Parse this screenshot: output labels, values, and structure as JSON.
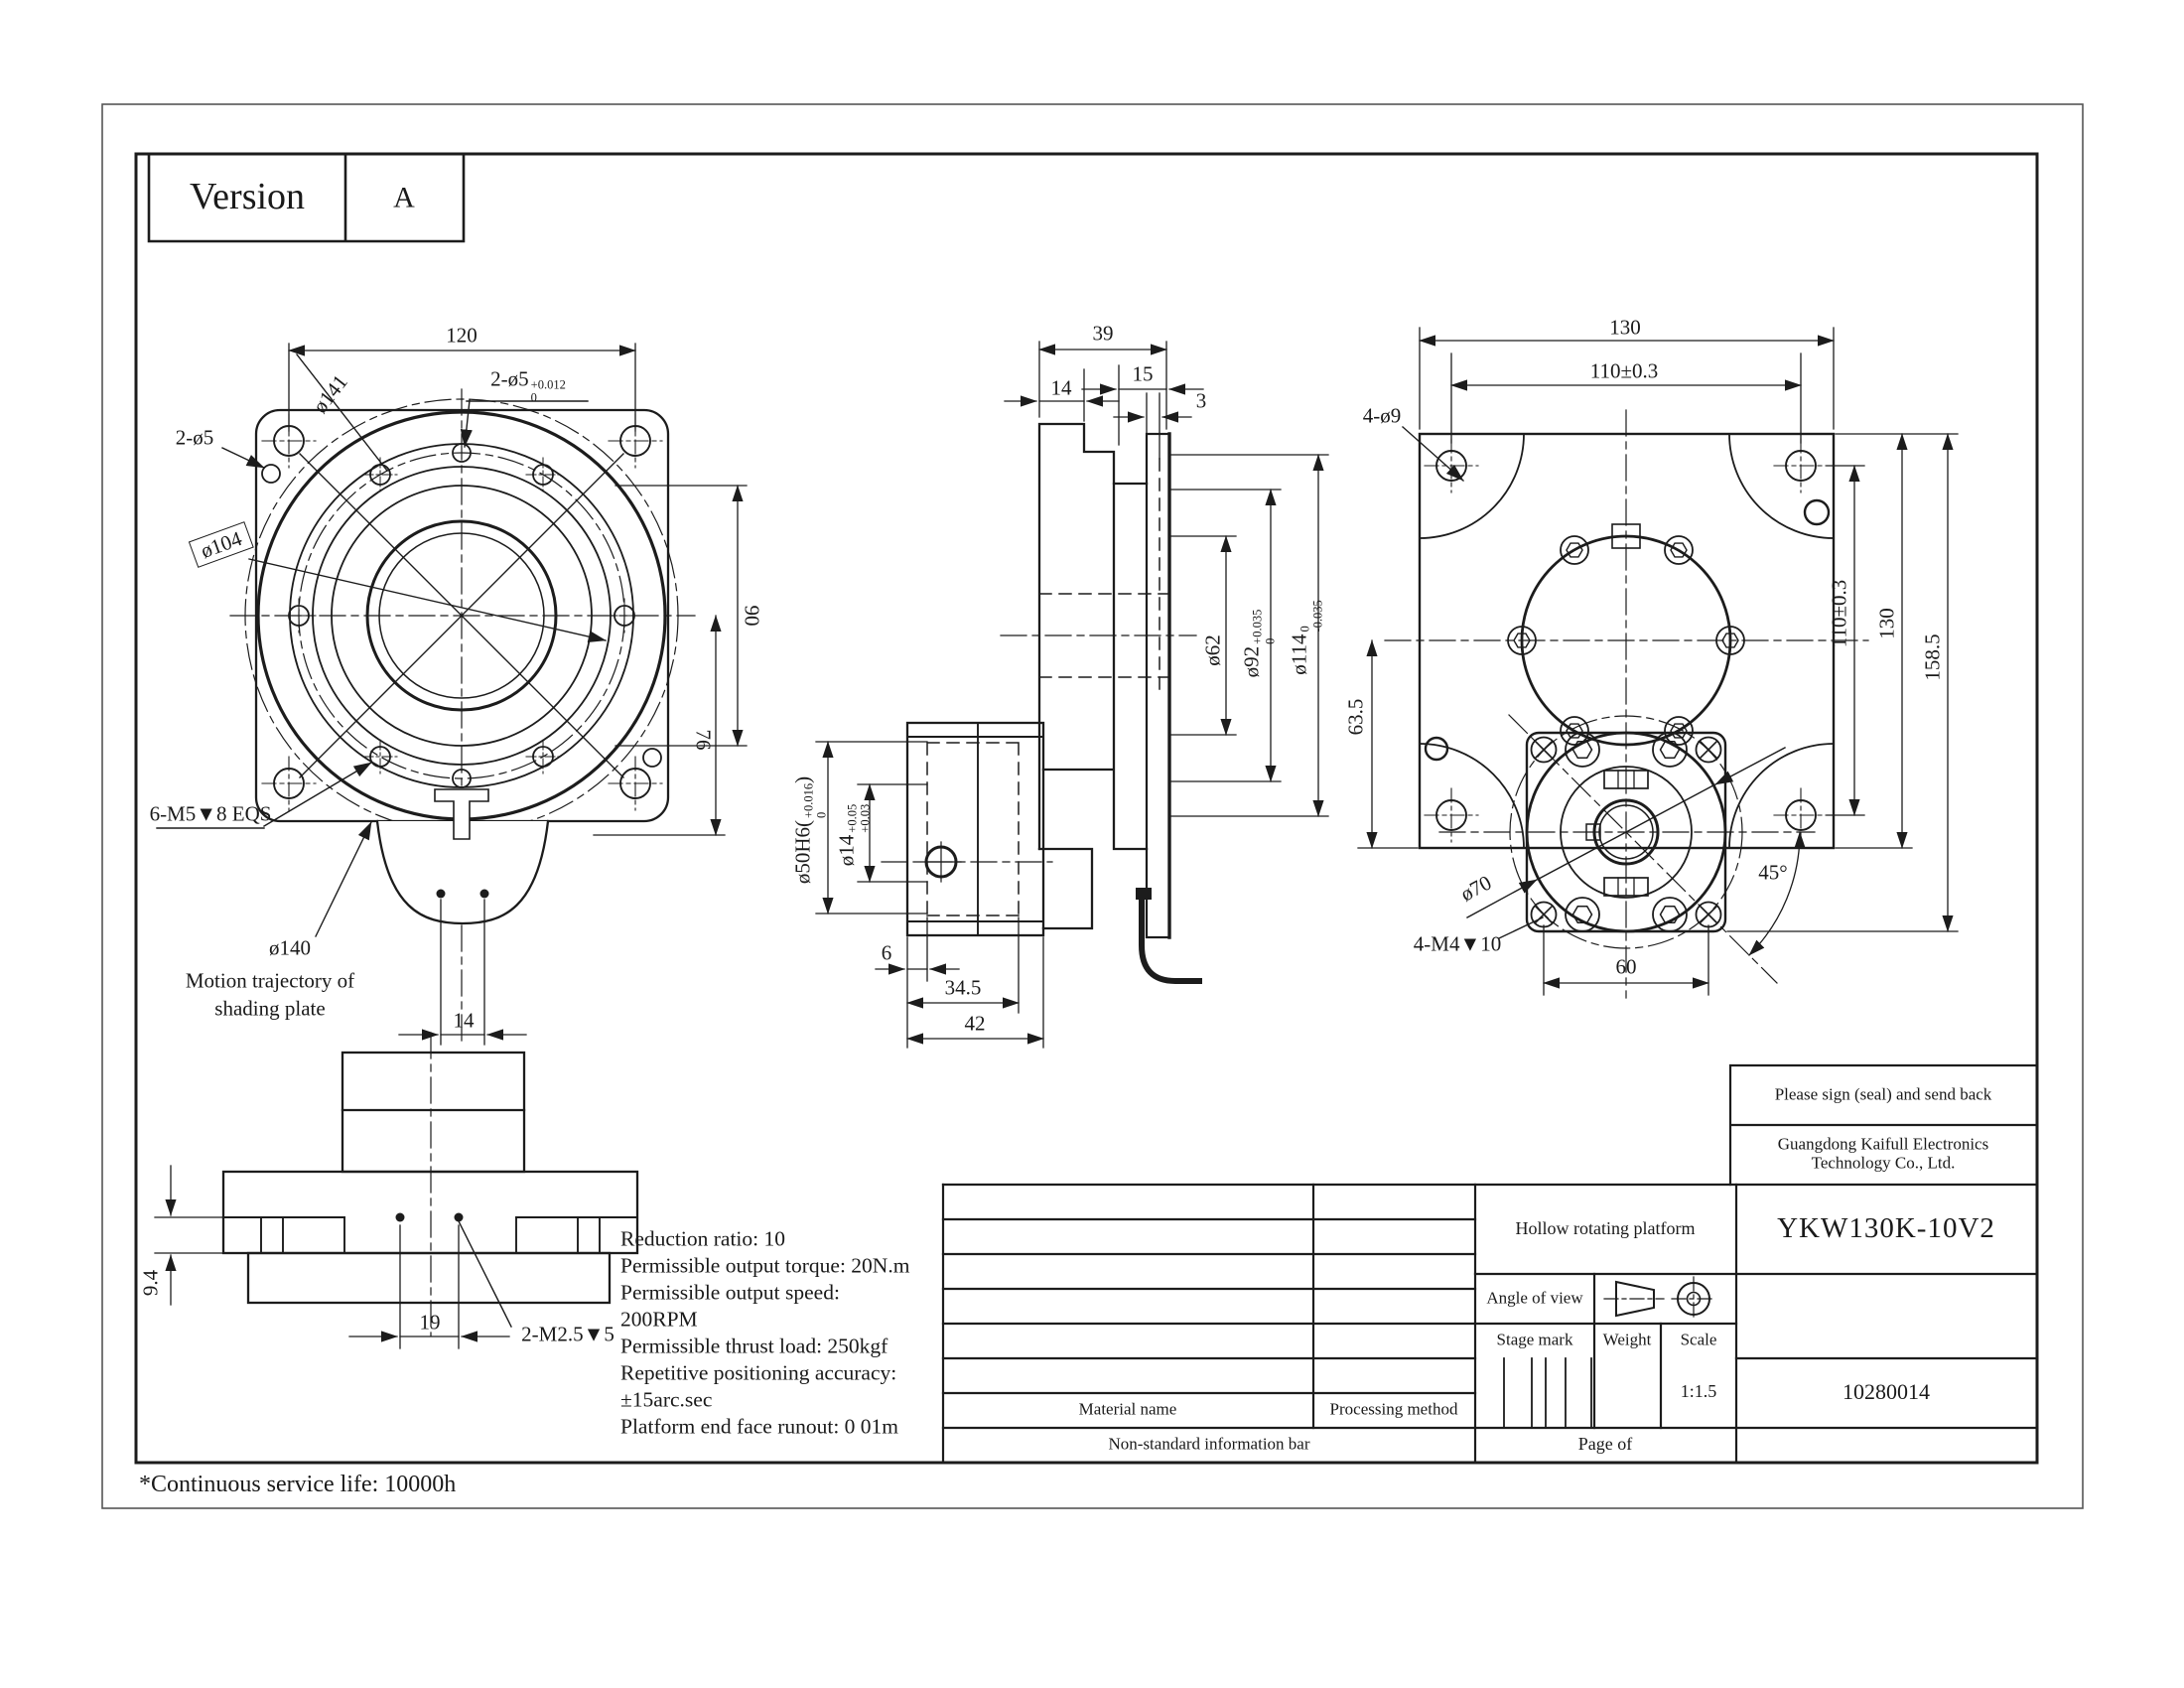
{
  "page": {
    "version_label": "Version",
    "version_value": "A",
    "footnote": "*Continuous service life: 10000h"
  },
  "specs": {
    "lines": [
      "Reduction ratio: 10",
      "Permissible output torque: 20N.m",
      "Permissible output speed:",
      "200RPM",
      "Permissible thrust load: 250kgf",
      "Repetitive positioning accuracy:",
      "±15arc.sec",
      "Platform end face runout: 0 01m"
    ]
  },
  "views": {
    "front": {
      "dims": {
        "d120": "120",
        "d90": "90",
        "d76": "76",
        "d14": "14"
      },
      "labels": {
        "d141": "ø141",
        "pin": "2-ø5",
        "pin_tol": {
          "pre": "2-ø5",
          "sup": "+0.012",
          "sub": "0"
        },
        "d104": "ø104",
        "screws": "6-M5▼8 EQS",
        "d140": "ø140",
        "motion1": "Motion trajectory of",
        "motion2": "shading plate"
      }
    },
    "bottom": {
      "dims": {
        "d9_4": "9.4",
        "d19": "19"
      },
      "labels": {
        "screws": "2-M2.5▼5"
      }
    },
    "section": {
      "dims": {
        "d39": "39",
        "d15": "15",
        "d14": "14",
        "d3": "3",
        "d6": "6",
        "d34_5": "34.5",
        "d42": "42"
      },
      "labels": {
        "d62": "ø62",
        "d92": {
          "pre": "ø92",
          "sup": "+0.035",
          "sub": "0"
        },
        "d114": {
          "pre": "ø114",
          "sup": "0",
          "sub": "-0.035"
        },
        "d50": {
          "pre": "ø50H6(",
          "sup": "+0.016",
          "sub": "0",
          "post": ")"
        },
        "d14t": {
          "pre": "ø14",
          "sup": "+0.05",
          "sub": "+0.03"
        }
      }
    },
    "rear": {
      "dims": {
        "d130_top": "130",
        "d110_top": "110±0.3",
        "d110_right": "110±0.3",
        "d130_right": "130",
        "d158_5": "158.5",
        "d63_5": "63.5",
        "d60": "60",
        "d45": "45°"
      },
      "labels": {
        "holes": "4-ø9",
        "d70": "ø70",
        "screws": "4-M4▼10"
      }
    }
  },
  "title_block": {
    "sign_note": "Please sign (seal) and send back",
    "company": "Guangdong Kaifull Electronics Technology Co., Ltd.",
    "product": "Hollow rotating platform",
    "model": "YKW130K-10V2",
    "angle_of_view": "Angle of view",
    "stage_mark": "Stage mark",
    "weight": "Weight",
    "scale_label": "Scale",
    "scale_value": "1:1.5",
    "part_number": "10280014",
    "material_name": "Material name",
    "processing_method": "Processing method",
    "non_standard": "Non-standard information bar",
    "page_of": "Page of"
  }
}
